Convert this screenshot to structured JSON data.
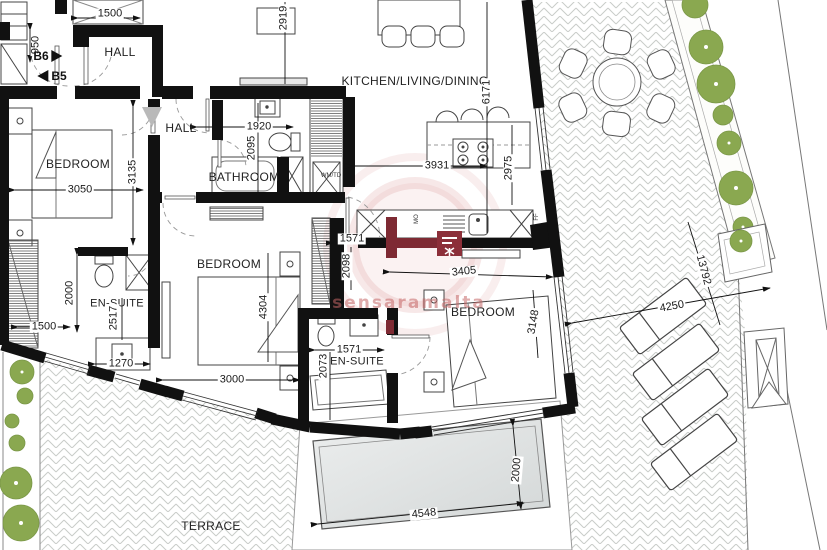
{
  "watermark": {
    "text": "sensaramalta"
  },
  "rooms": {
    "hall_top": "HALL",
    "hall_mid": "HALL",
    "bathroom": "BATHROOM",
    "bedroom_left": "BEDROOM",
    "bedroom_mid": "BEDROOM",
    "bedroom_right": "BEDROOM",
    "kitchen": "KITCHEN/LIVING/DINING",
    "ensuite_left": "EN-SUITE",
    "ensuite_mid": "EN-SUITE",
    "terrace": "TERRACE"
  },
  "units": {
    "b6": "B6",
    "b5": "B5"
  },
  "appliances": {
    "wmtd": "WM/TD",
    "mo": "MO",
    "ff": "FF"
  },
  "dimensions": {
    "d1500a": "1500",
    "d950": "950",
    "d2919": "2919",
    "d6171": "6171",
    "d1920": "1920",
    "d2095": "2095",
    "d3050": "3050",
    "d3135": "3135",
    "d3931": "3931",
    "d2975": "2975",
    "d1571a": "1571",
    "d2098": "2098",
    "d4304": "4304",
    "d3000": "3000",
    "d3405": "3405",
    "d1571b": "1571",
    "d2073": "2073",
    "d2000a": "2000",
    "d2517": "2517",
    "d1500b": "1500",
    "d1270": "1270",
    "d3148": "3148",
    "d4250": "4250",
    "d13792": "13792",
    "d4548": "4548",
    "d2000b": "2000"
  }
}
